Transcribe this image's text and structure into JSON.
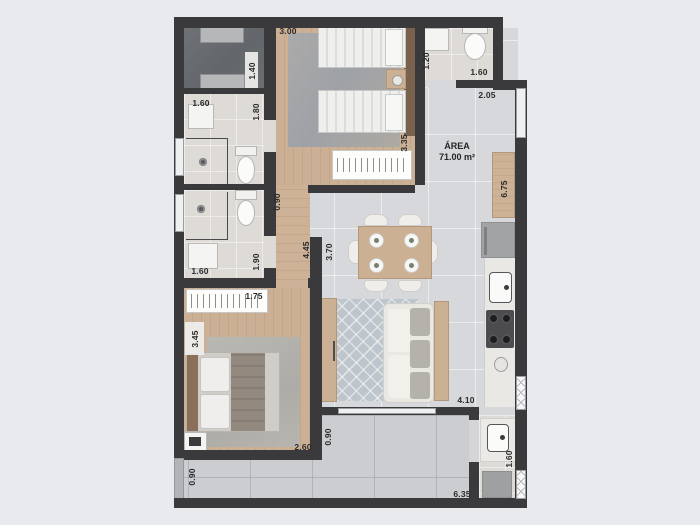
{
  "plan": {
    "area": {
      "title": "ÁREA",
      "value": "71.00 m²"
    },
    "dims": {
      "bedroom1_width": "3.00",
      "laundry_depth": "1.40",
      "bath1_width": "1.60",
      "bath1_depth": "1.80",
      "bedroom1_depth": "3.35",
      "bath_top_depth": "1.20",
      "bath_top_width": "1.60",
      "kitchen_top_width": "2.05",
      "kitchen_counter_length": "6.75",
      "hall_width": "0.90",
      "bath2_depth": "1.90",
      "bath2_width": "1.60",
      "hall_length": "4.45",
      "dining_width": "3.70",
      "wardrobe2_width": "1.75",
      "bedroom2_depth": "3.45",
      "bedroom2_width": "2.60",
      "living_door_width": "0.90",
      "living_width": "4.10",
      "terrace_depth": "0.90",
      "terrace_length": "6.35",
      "service_depth": "1.60"
    }
  }
}
